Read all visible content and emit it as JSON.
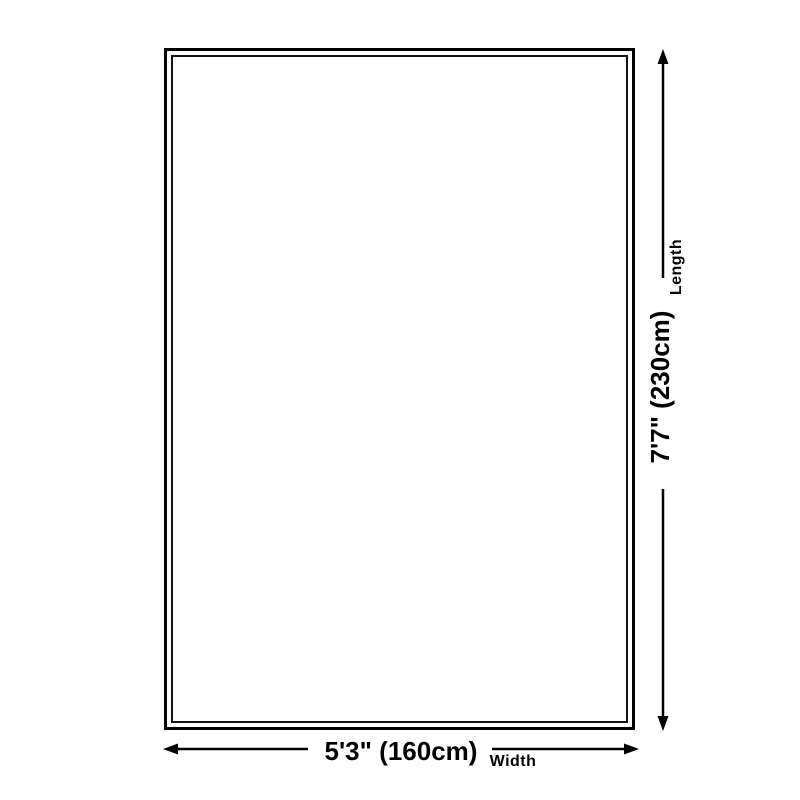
{
  "diagram": {
    "length": {
      "value": "7'7\" (230cm)",
      "label": "Length"
    },
    "width": {
      "value": "5'3\" (160cm)",
      "label": "Width"
    },
    "colors": {
      "line": "#000000",
      "rug_border": "#000000",
      "background": "#ffffff"
    }
  }
}
